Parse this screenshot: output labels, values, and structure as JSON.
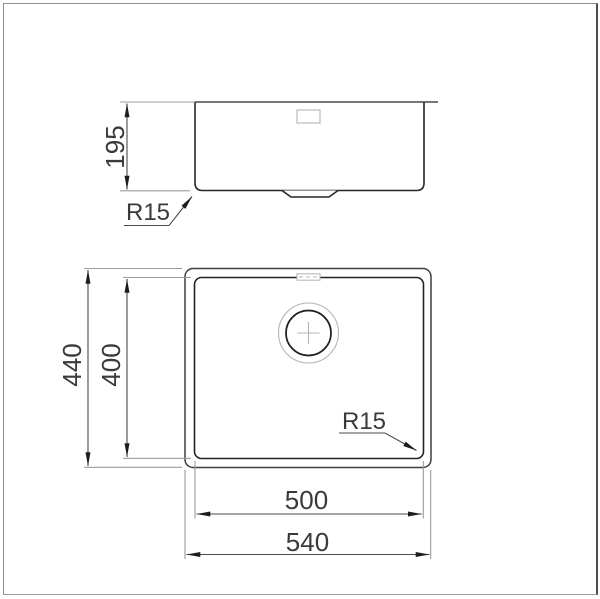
{
  "drawing": {
    "type": "kitchen-sink technical drawing, side elevation and plan view",
    "side_view": {
      "height": "195",
      "corner_radius": "R15"
    },
    "plan_view": {
      "overall_width": "540",
      "bowl_width": "500",
      "overall_depth": "440",
      "bowl_depth": "400",
      "corner_radius": "R15"
    },
    "colors": {
      "line_dark": "#262626",
      "line_medium": "#4a4a4a",
      "line_light": "#9b9b9b",
      "detail_light": "#b4b4b4",
      "text": "#3a3a3a",
      "frame": "#8d8d8d"
    }
  }
}
